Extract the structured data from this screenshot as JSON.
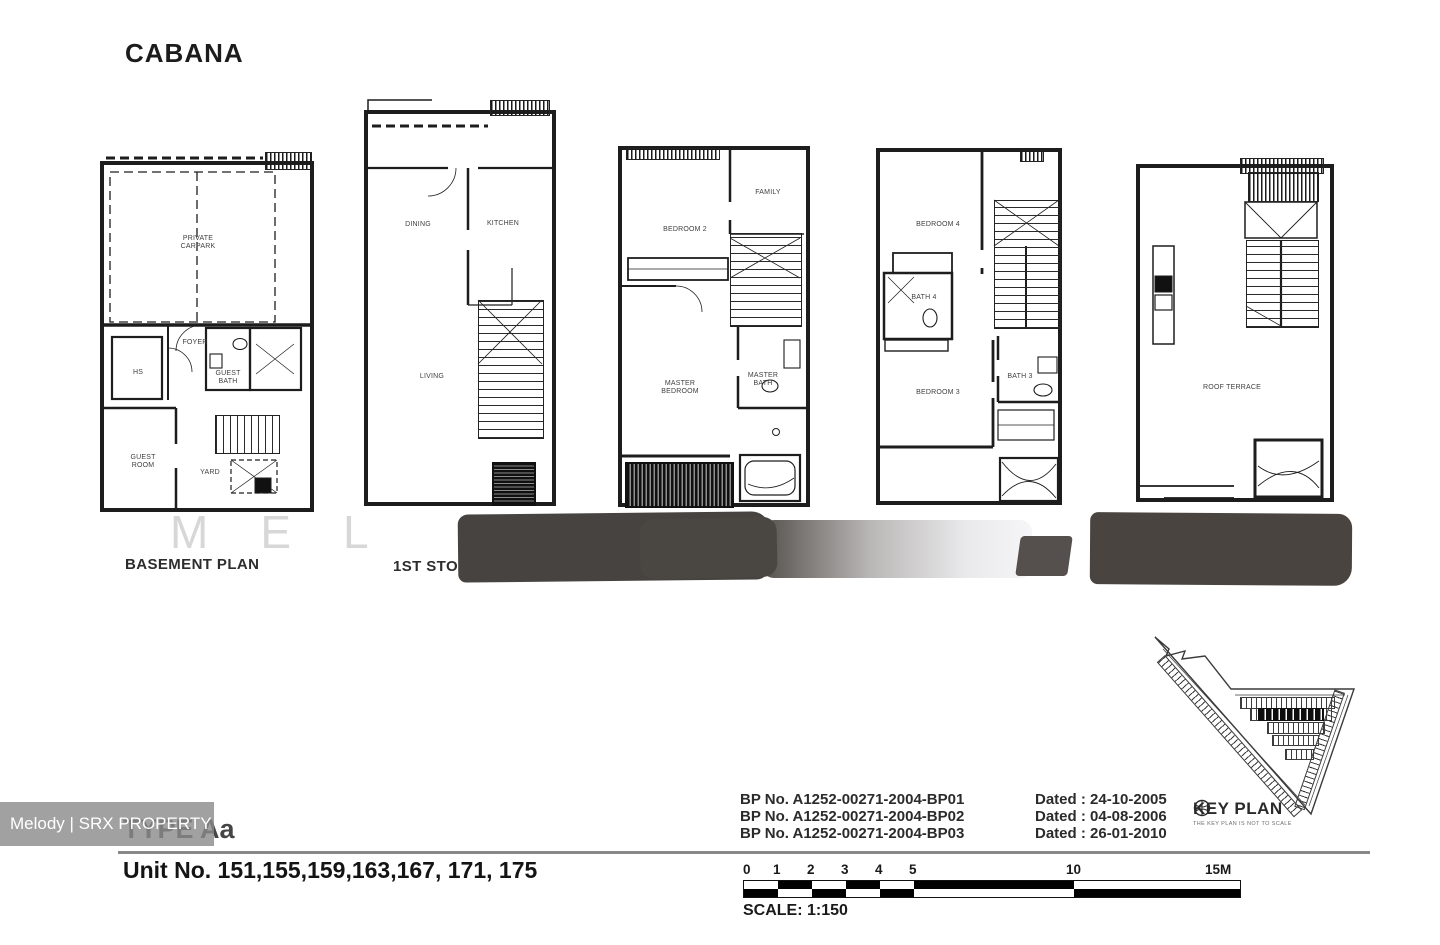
{
  "header": {
    "title": "CABANA"
  },
  "floorplans": {
    "basement": {
      "caption": "BASEMENT PLAN",
      "rooms": {
        "carpark": "PRIVATE CARPARK",
        "foyer": "FOYER",
        "hs": "HS",
        "guest_bath": "GUEST BATH",
        "guest_room": "GUEST ROOM",
        "yard": "YARD"
      }
    },
    "first": {
      "caption": "1ST STOREY",
      "rooms": {
        "dining": "DINING",
        "kitchen": "KITCHEN",
        "living": "LIVING"
      }
    },
    "second": {
      "rooms": {
        "bedroom2": "BEDROOM 2",
        "family": "FAMILY",
        "master_bedroom": "MASTER BEDROOM",
        "master_bath": "MASTER BATH"
      }
    },
    "third": {
      "rooms": {
        "bedroom4": "BEDROOM 4",
        "bath4": "BATH 4",
        "bedroom3": "BEDROOM 3",
        "bath3": "BATH 3"
      }
    },
    "roof": {
      "rooms": {
        "roof_terrace": "ROOF TERRACE"
      }
    }
  },
  "approvals": {
    "rows": [
      {
        "bp": "BP No. A1252-00271-2004-BP01",
        "dated": "Dated : 24-10-2005"
      },
      {
        "bp": "BP No. A1252-00271-2004-BP02",
        "dated": "Dated : 04-08-2006"
      },
      {
        "bp": "BP No. A1252-00271-2004-BP03",
        "dated": "Dated : 26-01-2010"
      }
    ]
  },
  "key_plan": {
    "label": "KEY PLAN",
    "note": "THE KEY PLAN IS NOT TO SCALE"
  },
  "footer": {
    "type": "TYPE Aa",
    "units": "Unit No. 151,155,159,163,167, 171, 175"
  },
  "scale_bar": {
    "ticks": [
      "0",
      "1",
      "2",
      "3",
      "4",
      "5",
      "10",
      "15M"
    ],
    "label": "SCALE: 1:150"
  },
  "watermark": {
    "agent": "Melody | SRX PROPERTY",
    "ghost": "MEL"
  },
  "colors": {
    "redaction_dark": "#474340",
    "watermark_box_gray": "#8c8c8c",
    "wall_ink": "#1d1d1d"
  }
}
